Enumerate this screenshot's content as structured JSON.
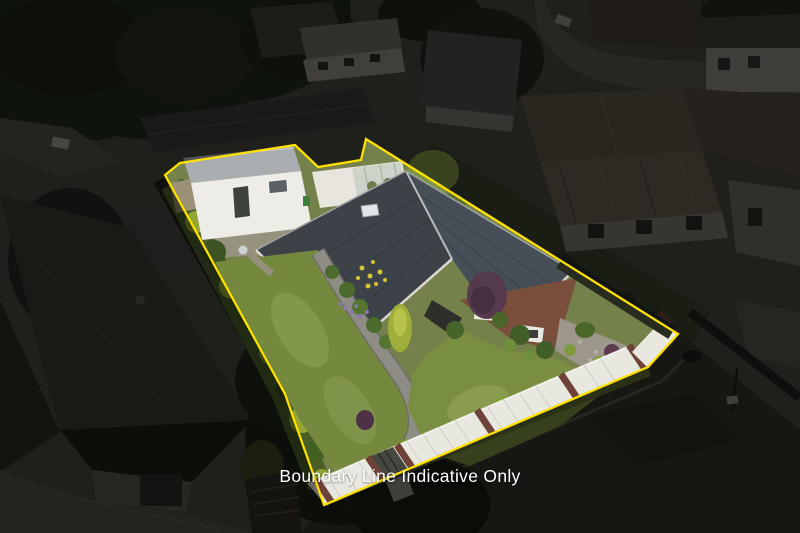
{
  "overlay": {
    "caption": "Boundary Line Indicative Only",
    "caption_color": "#ffffff"
  },
  "boundary": {
    "color": "#ffe100",
    "stroke_width": 2.25,
    "dim_opacity": 0.55,
    "points_svg": "165,175 180,163 295,145 318,167 361,160 366,139 678,334 648,367 324,505 285,394"
  },
  "scene": {
    "type": "aerial-property-photo",
    "palette": {
      "lawn": "#7a8c42",
      "roof_main": "#434a52",
      "garage_wall": "#edece6",
      "picket_fence": "#e8e7e0",
      "brick": "#794e3b",
      "road": "#32312b",
      "foliage_bright": "#8ea238",
      "foliage_dark": "#22271c"
    }
  }
}
